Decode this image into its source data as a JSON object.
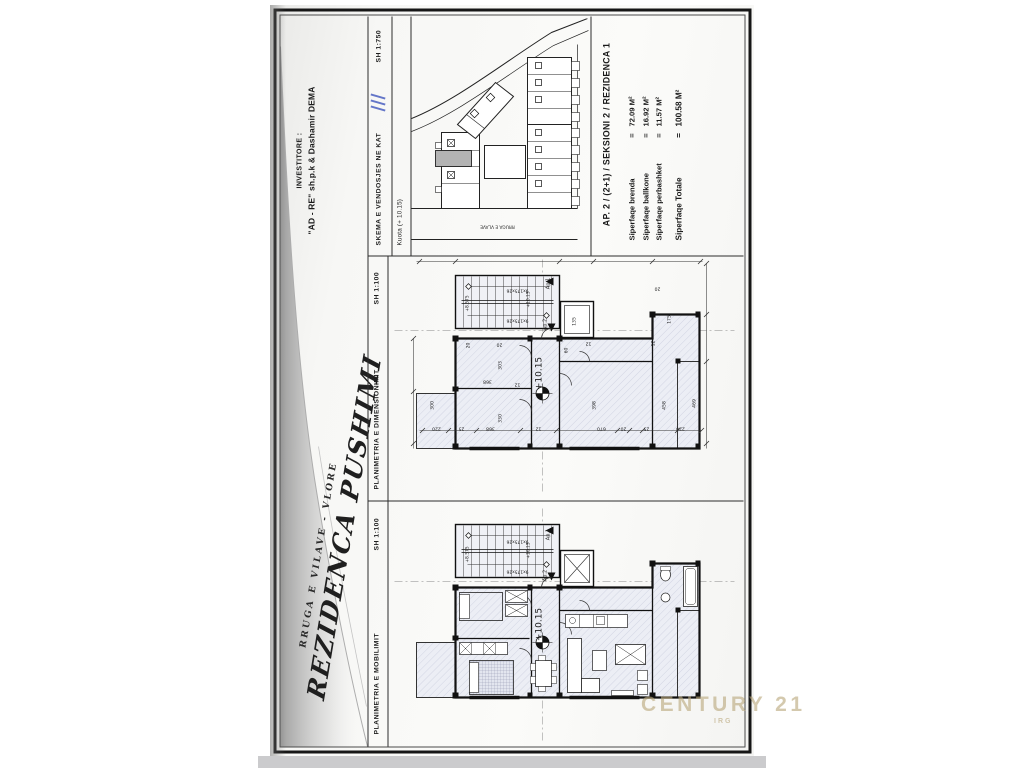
{
  "title_block": {
    "project_line1": "RRUGA E VILAVE - VLORE",
    "project_line2": "REZIDENCA PUSHIMI",
    "investor_label": "INVESTITORE :",
    "investor_name": "\"AD - RE\" sh.p.k & Dashamir DEMA"
  },
  "panels": {
    "mobilimit": {
      "title": "PLANIMETRIA E MOBILIMIT",
      "scale": "SH 1:100"
    },
    "dimensionimit": {
      "title": "PLANIMETRIA E DIMENSIONIMIT",
      "scale": "SH 1:100"
    },
    "skema": {
      "title": "SKEMA E VENDOSJES NE KAT",
      "scale": "SH 1:750",
      "kuota": "Kuota (+ 10.15)"
    }
  },
  "info": {
    "title": "AP. 2 / (2+1) / SEKSIONI 2 / REZIDENCA 1",
    "rows": [
      {
        "label": "Siperfaqe brenda",
        "eq": "=",
        "value": "72.09 M²",
        "bold": false
      },
      {
        "label": "Siperfaqe ballkone",
        "eq": "=",
        "value": "16.92 M²",
        "bold": false
      },
      {
        "label": "Siperfaqe perbashket",
        "eq": "=",
        "value": "11.57 M²",
        "bold": false
      },
      {
        "label": "Siperfaqe Totale",
        "eq": "=",
        "value": "100.58 M²",
        "bold": true
      }
    ]
  },
  "watermark": {
    "line1": "CENTURY 21",
    "line2": "IRG"
  },
  "colors": {
    "accent_blue": "#4a5fc0",
    "highlight_unit": "#b3b3b3",
    "watermark_gold": "#baa87c"
  },
  "plan_labels": {
    "dimension_plan": [
      {
        "t": "9x175x26",
        "x": 128,
        "y": 36,
        "r": 180,
        "s": 4.4
      },
      {
        "t": "9x175x26",
        "x": 128,
        "y": 66,
        "r": 180,
        "s": 4.4
      },
      {
        "t": "+8.575",
        "x": 79,
        "y": 50,
        "r": -90,
        "s": 4.4
      },
      {
        "t": "+10.15",
        "x": 140,
        "y": 46,
        "r": -90,
        "s": 4.4
      },
      {
        "t": "Ap.1",
        "x": 160,
        "y": 30,
        "r": -90,
        "s": 5
      },
      {
        "t": "Ap.2",
        "x": 157,
        "y": 71,
        "r": -90,
        "s": 5
      },
      {
        "t": "+10.15",
        "x": 152,
        "y": 120,
        "r": -90,
        "s": 9
      },
      {
        "t": "20",
        "x": 80,
        "y": 92,
        "r": -90,
        "s": 4.6
      },
      {
        "t": "20",
        "x": 110,
        "y": 90,
        "r": 180,
        "s": 4.6
      },
      {
        "t": "303",
        "x": 112,
        "y": 112,
        "r": -90,
        "s": 4.6
      },
      {
        "t": "368",
        "x": 98,
        "y": 127,
        "r": 180,
        "s": 4.6
      },
      {
        "t": "12",
        "x": 128,
        "y": 130,
        "r": 180,
        "s": 4.6
      },
      {
        "t": "300",
        "x": 44,
        "y": 152,
        "r": -90,
        "s": 4.6
      },
      {
        "t": "330",
        "x": 112,
        "y": 165,
        "r": -90,
        "s": 4.6
      },
      {
        "t": "398",
        "x": 206,
        "y": 152,
        "r": -90,
        "s": 4.6
      },
      {
        "t": "458",
        "x": 276,
        "y": 152,
        "r": -90,
        "s": 4.6
      },
      {
        "t": "469",
        "x": 306,
        "y": 150,
        "r": -90,
        "s": 4.6
      },
      {
        "t": "175",
        "x": 281,
        "y": 66,
        "r": -90,
        "s": 4.6
      },
      {
        "t": "135",
        "x": 186,
        "y": 68,
        "r": -90,
        "s": 4.6
      },
      {
        "t": "60",
        "x": 178,
        "y": 97,
        "r": -90,
        "s": 4.6
      },
      {
        "t": "12",
        "x": 199,
        "y": 89,
        "r": 180,
        "s": 4.6
      },
      {
        "t": "20",
        "x": 268,
        "y": 34,
        "r": 180,
        "s": 4.6
      },
      {
        "t": "12",
        "x": 265,
        "y": 90,
        "r": -90,
        "s": 4.6
      },
      {
        "t": "220",
        "x": 47,
        "y": 174,
        "r": 180,
        "s": 4.6
      },
      {
        "t": "25",
        "x": 72,
        "y": 174,
        "r": 180,
        "s": 4.6
      },
      {
        "t": "368",
        "x": 101,
        "y": 174,
        "r": 180,
        "s": 4.6
      },
      {
        "t": "12",
        "x": 149,
        "y": 174,
        "r": 180,
        "s": 4.6
      },
      {
        "t": "670",
        "x": 212,
        "y": 174,
        "r": 180,
        "s": 4.6
      },
      {
        "t": "20",
        "x": 234,
        "y": 174,
        "r": 180,
        "s": 4.6
      },
      {
        "t": "25",
        "x": 257,
        "y": 174,
        "r": 180,
        "s": 4.6
      },
      {
        "t": "220",
        "x": 291,
        "y": 174,
        "r": 180,
        "s": 4.6
      }
    ],
    "furniture_plan": [
      {
        "t": "9x175x26",
        "x": 128,
        "y": 38,
        "r": 180,
        "s": 4.4
      },
      {
        "t": "9x175x26",
        "x": 128,
        "y": 68,
        "r": 180,
        "s": 4.4
      },
      {
        "t": "+8.575",
        "x": 79,
        "y": 52,
        "r": -90,
        "s": 4.4
      },
      {
        "t": "+10.15",
        "x": 140,
        "y": 48,
        "r": -90,
        "s": 4.4
      },
      {
        "t": "Ap.1",
        "x": 160,
        "y": 32,
        "r": -90,
        "s": 5
      },
      {
        "t": "Ap.2",
        "x": 157,
        "y": 73,
        "r": -90,
        "s": 5
      },
      {
        "t": "+10.15",
        "x": 152,
        "y": 122,
        "r": -90,
        "s": 9
      }
    ],
    "site_plan": [
      {
        "t": "RRUGA E VLAVE",
        "x": 86,
        "y": 207,
        "r": 180,
        "s": 4.3
      }
    ]
  }
}
